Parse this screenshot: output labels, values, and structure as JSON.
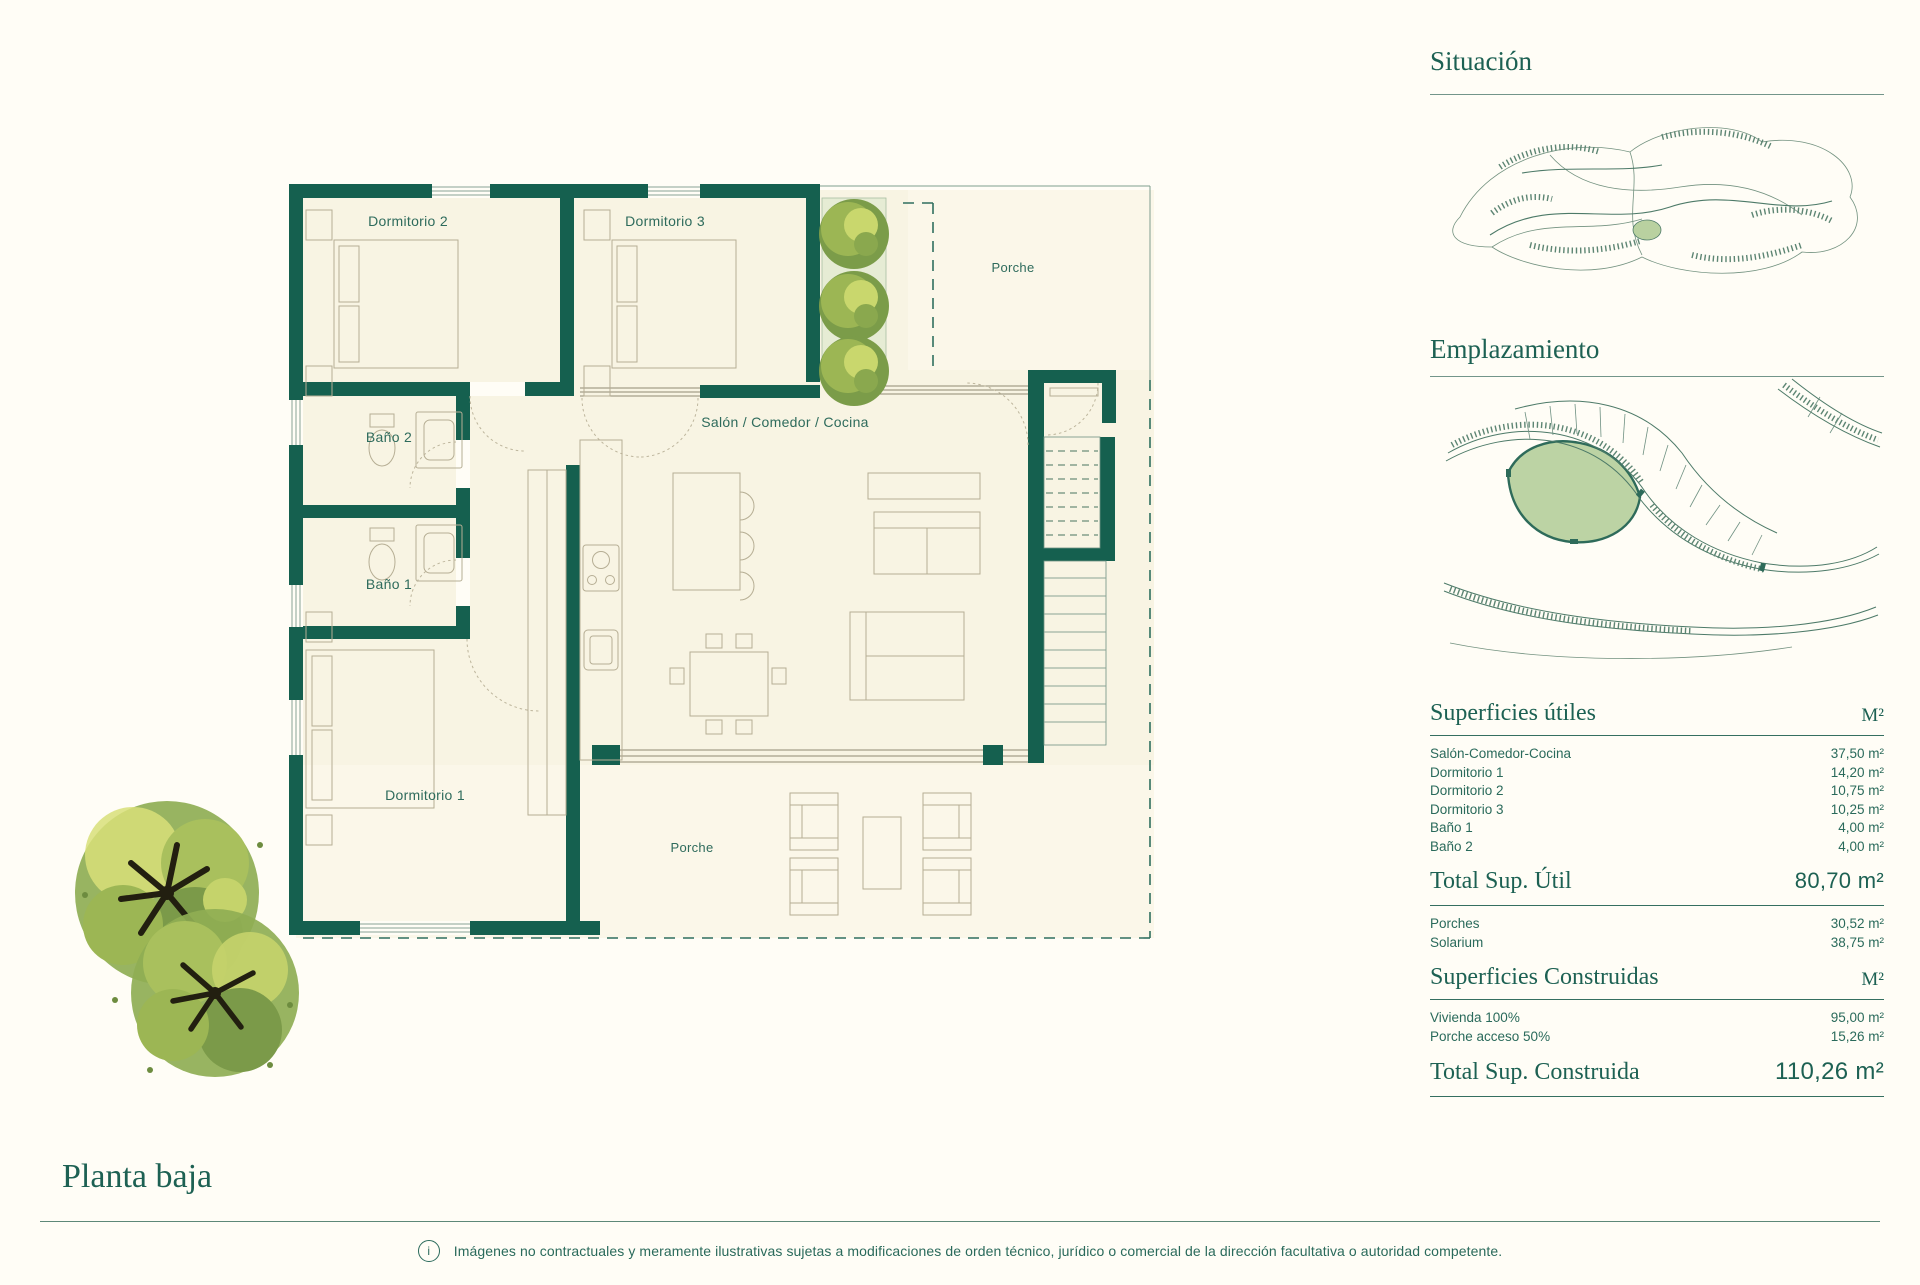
{
  "page": {
    "background": "#fffdf6",
    "wall_color": "#15604f",
    "text_teal": "#2a6a5b",
    "heading_color": "#1d6153",
    "plot_green": "#bcd3a4"
  },
  "floor_plan": {
    "title": "Planta baja",
    "labels": {
      "dormitorio_2": "Dormitorio 2",
      "dormitorio_3": "Dormitorio 3",
      "porche_top": "Porche",
      "salon": "Salón / Comedor / Cocina",
      "bano_2": "Baño 2",
      "bano_1": "Baño 1",
      "dormitorio_1": "Dormitorio 1",
      "porche_bottom": "Porche"
    }
  },
  "right_column": {
    "situacion_heading": "Situación",
    "emplazamiento_heading": "Emplazamiento",
    "superficies_utiles": {
      "title": "Superficies útiles",
      "unit": "M²",
      "rows": [
        {
          "label": "Salón-Comedor-Cocina",
          "value": "37,50 m²"
        },
        {
          "label": "Dormitorio 1",
          "value": "14,20 m²"
        },
        {
          "label": "Dormitorio 2",
          "value": "10,75 m²"
        },
        {
          "label": "Dormitorio 3",
          "value": "10,25 m²"
        },
        {
          "label": "Baño 1",
          "value": "4,00 m²"
        },
        {
          "label": "Baño 2",
          "value": "4,00 m²"
        }
      ],
      "total_label": "Total Sup. Útil",
      "total_value": "80,70 m²"
    },
    "exteriores": [
      {
        "label": "Porches",
        "value": "30,52 m²"
      },
      {
        "label": "Solarium",
        "value": "38,75 m²"
      }
    ],
    "superficies_construidas": {
      "title": "Superficies Construidas",
      "unit": "M²",
      "rows": [
        {
          "label": "Vivienda 100%",
          "value": "95,00 m²"
        },
        {
          "label": "Porche acceso 50%",
          "value": "15,26 m²"
        }
      ],
      "total_label": "Total Sup. Construida",
      "total_value": "110,26 m²"
    }
  },
  "footer": {
    "info_symbol": "i",
    "disclaimer": "Imágenes no contractuales y meramente ilustrativas sujetas a modificaciones de orden técnico, jurídico o comercial de la dirección facultativa o autoridad competente."
  }
}
